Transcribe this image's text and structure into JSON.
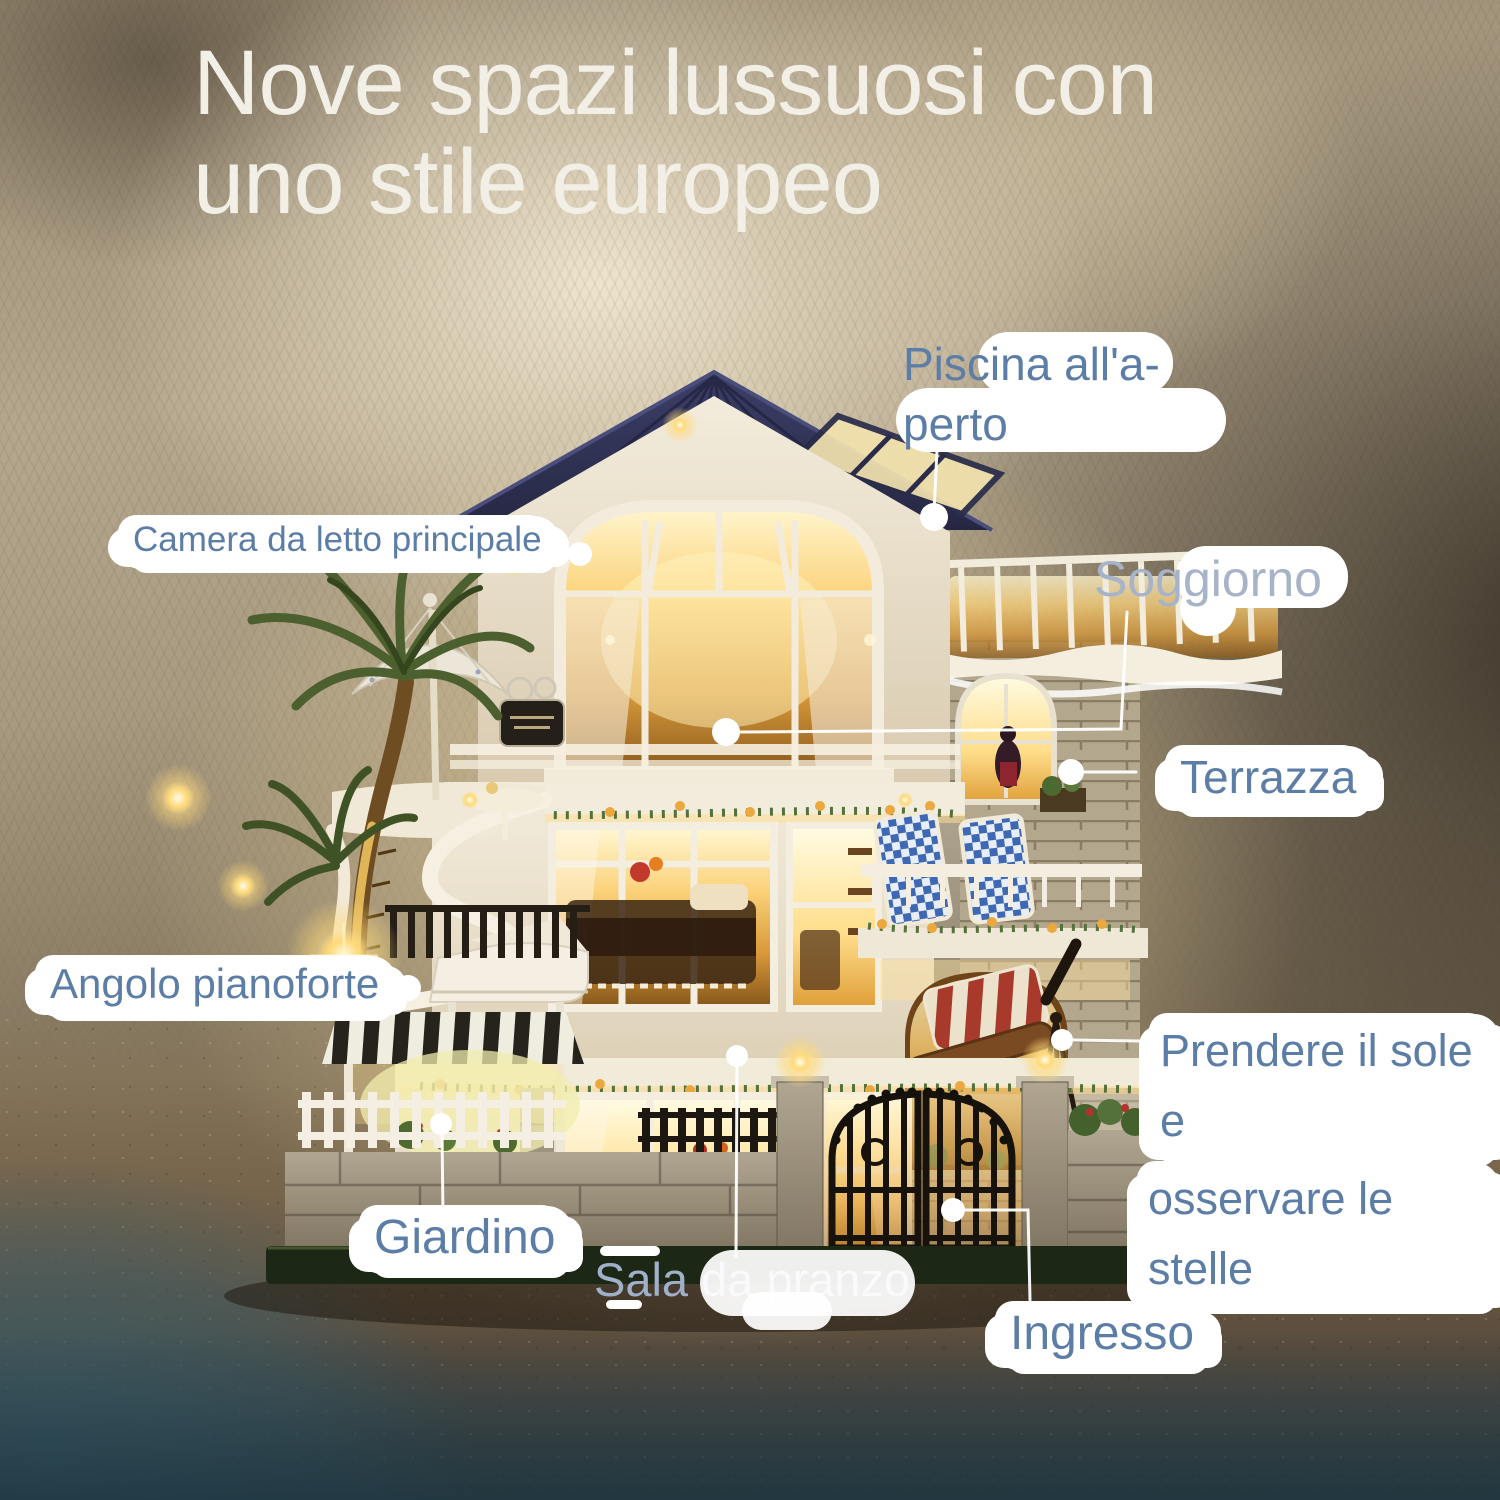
{
  "title": {
    "line1": "Nove spazi lussuosi con",
    "line2": "uno stile europeo"
  },
  "callouts": {
    "piscina": {
      "line1": "Piscina all'a-",
      "line2": "perto"
    },
    "camera": {
      "text": "Camera da letto principale"
    },
    "soggiorno": {
      "text": "Soggiorno"
    },
    "terrazza": {
      "text": "Terrazza"
    },
    "angolo": {
      "text": "Angolo pianoforte"
    },
    "prendere": {
      "line1": "Prendere il sole e",
      "line2": "osservare le stelle"
    },
    "giardino": {
      "text": "Giardino"
    },
    "sala": {
      "text": "Sala da pranzo"
    },
    "ingresso": {
      "text": "Ingresso"
    }
  },
  "palette": {
    "title_text": "#f2efe7",
    "label_text": "#5b7da6",
    "label_text_faded": "#9fb0c8",
    "leader_line": "#ffffff",
    "roof": "#2c2e4e",
    "window_glow": "#f0bd5a",
    "fabric": "#b5a78d",
    "sand": "#6b5a45",
    "water": "#35596a",
    "gate_iron": "#17130c"
  }
}
